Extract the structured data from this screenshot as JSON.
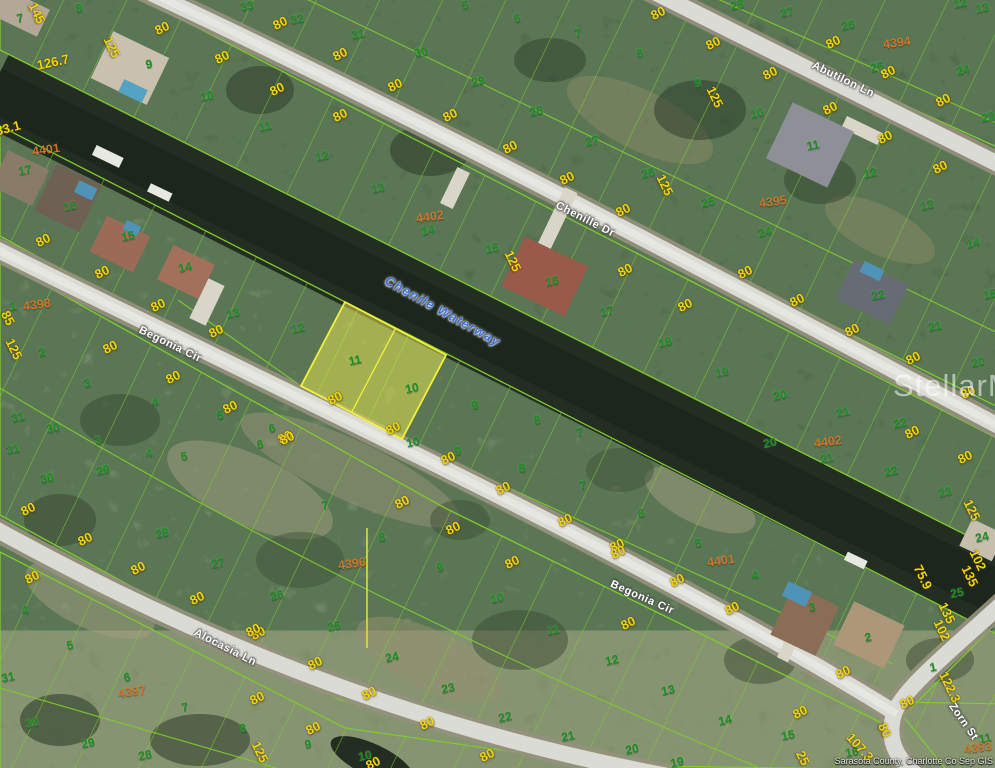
{
  "meta": {
    "watermark": "StellarMLS",
    "attribution": "Sarasota County, Charlotte Co Sep GIS",
    "highlighted_lots": [
      "11",
      "10"
    ]
  },
  "colors": {
    "parcel_line": "#7fcb2d",
    "highlight_fill": "#ebe950",
    "highlight_stroke": "#f3f13a",
    "lot_number": "#1d9021",
    "dimension": "#f2d40e",
    "block_number": "#c9762a",
    "street_text": "#ffffff",
    "waterway_text": "#3a6fd8",
    "water": "#232d22",
    "road": "#dadbd4",
    "watermark": "#ffffff"
  },
  "map": {
    "labels": [
      [
        "33",
        247,
        6,
        "lot"
      ],
      [
        "32",
        297,
        19,
        "lot"
      ],
      [
        "31",
        358,
        34,
        "lot"
      ],
      [
        "30",
        421,
        52,
        "lot"
      ],
      [
        "29",
        478,
        81,
        "lot"
      ],
      [
        "28",
        536,
        111,
        "lot"
      ],
      [
        "27",
        592,
        141,
        "lot"
      ],
      [
        "26",
        648,
        173,
        "lot"
      ],
      [
        "28",
        737,
        5,
        "lot"
      ],
      [
        "27",
        787,
        12,
        "lot"
      ],
      [
        "26",
        848,
        25,
        "lot"
      ],
      [
        "25",
        877,
        67,
        "lot"
      ],
      [
        "24",
        963,
        70,
        "lot"
      ],
      [
        "23",
        988,
        117,
        "lot"
      ],
      [
        "12",
        960,
        3,
        "lot"
      ],
      [
        "13",
        982,
        8,
        "lot"
      ],
      [
        "5",
        465,
        5,
        "lot"
      ],
      [
        "6",
        517,
        18,
        "lot"
      ],
      [
        "7",
        578,
        33,
        "lot"
      ],
      [
        "8",
        640,
        53,
        "lot"
      ],
      [
        "9",
        698,
        83,
        "lot"
      ],
      [
        "10",
        757,
        113,
        "lot"
      ],
      [
        "11",
        813,
        145,
        "lot"
      ],
      [
        "12",
        870,
        173,
        "lot"
      ],
      [
        "13",
        927,
        205,
        "lot"
      ],
      [
        "14",
        973,
        243,
        "lot"
      ],
      [
        "15",
        990,
        294,
        "lot"
      ],
      [
        "25",
        708,
        202,
        "lot"
      ],
      [
        "24",
        765,
        232,
        "lot"
      ],
      [
        "7",
        20,
        18,
        "lot"
      ],
      [
        "8",
        79,
        8,
        "lot"
      ],
      [
        "9",
        149,
        64,
        "lot"
      ],
      [
        "10",
        207,
        96,
        "lot"
      ],
      [
        "11",
        265,
        126,
        "lot"
      ],
      [
        "12",
        322,
        156,
        "lot"
      ],
      [
        "13",
        378,
        188,
        "lot"
      ],
      [
        "14",
        428,
        230,
        "lot"
      ],
      [
        "15",
        492,
        248,
        "lot"
      ],
      [
        "16",
        552,
        281,
        "lot"
      ],
      [
        "17",
        607,
        311,
        "lot"
      ],
      [
        "18",
        665,
        342,
        "lot"
      ],
      [
        "19",
        722,
        372,
        "lot"
      ],
      [
        "20",
        780,
        395,
        "lot"
      ],
      [
        "21",
        843,
        412,
        "lot"
      ],
      [
        "22",
        900,
        423,
        "lot"
      ],
      [
        "22",
        878,
        295,
        "lot"
      ],
      [
        "21",
        935,
        326,
        "lot"
      ],
      [
        "20",
        978,
        362,
        "lot"
      ],
      [
        "20",
        770,
        443,
        "lot"
      ],
      [
        "21",
        827,
        458,
        "lot"
      ],
      [
        "22",
        891,
        471,
        "lot"
      ],
      [
        "23",
        945,
        492,
        "lot"
      ],
      [
        "24",
        982,
        537,
        "lot"
      ],
      [
        "25",
        957,
        593,
        "lot"
      ],
      [
        "17",
        25,
        170,
        "lot"
      ],
      [
        "16",
        70,
        206,
        "lot"
      ],
      [
        "15",
        128,
        236,
        "lot"
      ],
      [
        "14",
        185,
        267,
        "lot"
      ],
      [
        "13",
        233,
        313,
        "lot"
      ],
      [
        "12",
        298,
        328,
        "lot"
      ],
      [
        "11",
        355,
        360,
        "lot"
      ],
      [
        "10",
        412,
        388,
        "lot"
      ],
      [
        "10",
        413,
        442,
        "lot"
      ],
      [
        "9",
        475,
        405,
        "lot"
      ],
      [
        "8",
        537,
        420,
        "lot"
      ],
      [
        "7",
        580,
        432,
        "lot"
      ],
      [
        "9",
        458,
        451,
        "lot"
      ],
      [
        "8",
        522,
        468,
        "lot"
      ],
      [
        "7",
        583,
        485,
        "lot"
      ],
      [
        "6",
        641,
        513,
        "lot"
      ],
      [
        "5",
        698,
        543,
        "lot"
      ],
      [
        "4",
        755,
        575,
        "lot"
      ],
      [
        "3",
        812,
        607,
        "lot"
      ],
      [
        "2",
        868,
        637,
        "lot"
      ],
      [
        "1",
        933,
        667,
        "lot"
      ],
      [
        "1",
        13,
        306,
        "lot"
      ],
      [
        "2",
        42,
        352,
        "lot"
      ],
      [
        "3",
        87,
        383,
        "lot"
      ],
      [
        "4",
        155,
        402,
        "lot"
      ],
      [
        "5",
        220,
        415,
        "lot"
      ],
      [
        "6",
        272,
        428,
        "lot"
      ],
      [
        "31",
        18,
        417,
        "lot"
      ],
      [
        "30",
        53,
        428,
        "lot"
      ],
      [
        "3",
        98,
        440,
        "lot"
      ],
      [
        "4",
        149,
        453,
        "lot"
      ],
      [
        "5",
        184,
        456,
        "lot"
      ],
      [
        "6",
        260,
        444,
        "lot"
      ],
      [
        "31",
        13,
        449,
        "lot"
      ],
      [
        "29",
        103,
        470,
        "lot"
      ],
      [
        "30",
        47,
        478,
        "lot"
      ],
      [
        "7",
        325,
        505,
        "lot"
      ],
      [
        "28",
        162,
        533,
        "lot"
      ],
      [
        "27",
        218,
        563,
        "lot"
      ],
      [
        "26",
        277,
        595,
        "lot"
      ],
      [
        "25",
        334,
        626,
        "lot"
      ],
      [
        "8",
        382,
        537,
        "lot"
      ],
      [
        "9",
        440,
        567,
        "lot"
      ],
      [
        "10",
        497,
        598,
        "lot"
      ],
      [
        "11",
        553,
        630,
        "lot"
      ],
      [
        "12",
        612,
        660,
        "lot"
      ],
      [
        "13",
        668,
        690,
        "lot"
      ],
      [
        "24",
        392,
        657,
        "lot"
      ],
      [
        "23",
        448,
        688,
        "lot"
      ],
      [
        "22",
        505,
        717,
        "lot"
      ],
      [
        "21",
        568,
        736,
        "lot"
      ],
      [
        "20",
        632,
        749,
        "lot"
      ],
      [
        "19",
        677,
        762,
        "lot"
      ],
      [
        "4",
        25,
        610,
        "lot"
      ],
      [
        "5",
        70,
        645,
        "lot"
      ],
      [
        "6",
        127,
        677,
        "lot"
      ],
      [
        "7",
        185,
        707,
        "lot"
      ],
      [
        "8",
        243,
        728,
        "lot"
      ],
      [
        "9",
        308,
        744,
        "lot"
      ],
      [
        "10",
        365,
        756,
        "lot"
      ],
      [
        "31",
        8,
        677,
        "lot"
      ],
      [
        "30",
        32,
        723,
        "lot"
      ],
      [
        "29",
        88,
        743,
        "lot"
      ],
      [
        "28",
        145,
        755,
        "lot"
      ],
      [
        "14",
        725,
        720,
        "lot"
      ],
      [
        "15",
        788,
        735,
        "lot"
      ],
      [
        "16",
        852,
        752,
        "lot"
      ],
      [
        "11",
        985,
        738,
        "lot"
      ],
      [
        "80",
        162,
        28,
        "dim"
      ],
      [
        "80",
        222,
        57,
        "dim"
      ],
      [
        "80",
        280,
        23,
        "dim"
      ],
      [
        "80",
        277,
        89,
        "dim"
      ],
      [
        "80",
        340,
        115,
        "dim"
      ],
      [
        "80",
        340,
        54,
        "dim"
      ],
      [
        "80",
        395,
        85,
        "dim"
      ],
      [
        "80",
        450,
        115,
        "dim"
      ],
      [
        "80",
        510,
        147,
        "dim"
      ],
      [
        "80",
        567,
        178,
        "dim"
      ],
      [
        "80",
        623,
        210,
        "dim"
      ],
      [
        "80",
        658,
        13,
        "dim"
      ],
      [
        "80",
        713,
        43,
        "dim"
      ],
      [
        "80",
        770,
        73,
        "dim"
      ],
      [
        "80",
        833,
        42,
        "dim"
      ],
      [
        "80",
        888,
        72,
        "dim"
      ],
      [
        "80",
        943,
        100,
        "dim"
      ],
      [
        "80",
        830,
        108,
        "dim"
      ],
      [
        "80",
        885,
        137,
        "dim"
      ],
      [
        "80",
        940,
        167,
        "dim"
      ],
      [
        "80",
        43,
        240,
        "dim"
      ],
      [
        "80",
        102,
        272,
        "dim"
      ],
      [
        "80",
        158,
        305,
        "dim"
      ],
      [
        "80",
        110,
        347,
        "dim"
      ],
      [
        "80",
        173,
        377,
        "dim"
      ],
      [
        "80",
        216,
        331,
        "dim"
      ],
      [
        "80",
        230,
        407,
        "dim"
      ],
      [
        "80",
        285,
        437,
        "dim"
      ],
      [
        "80",
        335,
        398,
        "dim"
      ],
      [
        "80",
        393,
        428,
        "dim"
      ],
      [
        "80",
        448,
        458,
        "dim"
      ],
      [
        "80",
        503,
        488,
        "dim"
      ],
      [
        "80",
        565,
        520,
        "dim"
      ],
      [
        "80",
        617,
        545,
        "dim"
      ],
      [
        "80",
        453,
        528,
        "dim"
      ],
      [
        "80",
        625,
        270,
        "dim"
      ],
      [
        "80",
        685,
        305,
        "dim"
      ],
      [
        "80",
        745,
        272,
        "dim"
      ],
      [
        "80",
        797,
        300,
        "dim"
      ],
      [
        "80",
        852,
        330,
        "dim"
      ],
      [
        "80",
        913,
        358,
        "dim"
      ],
      [
        "80",
        968,
        392,
        "dim"
      ],
      [
        "80",
        912,
        432,
        "dim"
      ],
      [
        "80",
        965,
        457,
        "dim"
      ],
      [
        "80",
        402,
        502,
        "dim"
      ],
      [
        "80",
        512,
        562,
        "dim"
      ],
      [
        "80",
        618,
        552,
        "dim"
      ],
      [
        "80",
        258,
        633,
        "dim"
      ],
      [
        "80",
        315,
        663,
        "dim"
      ],
      [
        "80",
        369,
        693,
        "dim"
      ],
      [
        "80",
        427,
        723,
        "dim"
      ],
      [
        "80",
        487,
        755,
        "dim"
      ],
      [
        "80",
        628,
        623,
        "dim"
      ],
      [
        "80",
        373,
        763,
        "dim"
      ],
      [
        "80",
        28,
        509,
        "dim"
      ],
      [
        "80",
        85,
        539,
        "dim"
      ],
      [
        "80",
        138,
        568,
        "dim"
      ],
      [
        "80",
        32,
        577,
        "dim"
      ],
      [
        "80",
        287,
        438,
        "dim"
      ],
      [
        "80",
        197,
        598,
        "dim"
      ],
      [
        "80",
        253,
        630,
        "dim"
      ],
      [
        "80",
        257,
        698,
        "dim"
      ],
      [
        "80",
        313,
        728,
        "dim"
      ],
      [
        "80",
        677,
        580,
        "dim"
      ],
      [
        "80",
        732,
        608,
        "dim"
      ],
      [
        "80",
        800,
        712,
        "dim"
      ],
      [
        "80",
        907,
        702,
        "dim"
      ],
      [
        "80",
        843,
        672,
        "dim"
      ],
      [
        "80",
        885,
        730,
        "dim",
        64
      ],
      [
        "126.7",
        53,
        62,
        "dim",
        -12
      ],
      [
        "33.1",
        8,
        128,
        "dim",
        -15
      ],
      [
        "145",
        37,
        13,
        "dim",
        64
      ],
      [
        "125",
        112,
        47,
        "dim",
        64
      ],
      [
        "125",
        715,
        97,
        "dim",
        64
      ],
      [
        "125",
        665,
        185,
        "dim",
        64
      ],
      [
        "125",
        513,
        261,
        "dim",
        64
      ],
      [
        "85",
        8,
        318,
        "dim",
        64
      ],
      [
        "125",
        14,
        349,
        "dim",
        64
      ],
      [
        "125",
        972,
        510,
        "dim",
        64
      ],
      [
        "102",
        978,
        560,
        "dim",
        64
      ],
      [
        "135",
        970,
        576,
        "dim",
        64
      ],
      [
        "75.9",
        923,
        577,
        "dim",
        64
      ],
      [
        "135",
        947,
        613,
        "dim",
        64
      ],
      [
        "102",
        942,
        630,
        "dim",
        64
      ],
      [
        "122.3",
        950,
        687,
        "dim",
        64
      ],
      [
        "107.3",
        860,
        747,
        "dim",
        48
      ],
      [
        "25",
        803,
        758,
        "dim",
        64
      ],
      [
        "125",
        260,
        752,
        "dim",
        64
      ],
      [
        "4394",
        897,
        43,
        "blk"
      ],
      [
        "4395",
        773,
        202,
        "blk"
      ],
      [
        "4402",
        430,
        217,
        "blk"
      ],
      [
        "4402",
        828,
        442,
        "blk"
      ],
      [
        "4401",
        46,
        150,
        "blk"
      ],
      [
        "4401",
        721,
        561,
        "blk"
      ],
      [
        "4398",
        37,
        305,
        "blk"
      ],
      [
        "4396",
        352,
        564,
        "blk"
      ],
      [
        "4397",
        132,
        692,
        "blk"
      ],
      [
        "4393",
        978,
        748,
        "blk"
      ],
      [
        "Chenille Dr",
        585,
        220,
        "st",
        27
      ],
      [
        "Abutilon Ln",
        843,
        80,
        "st",
        26
      ],
      [
        "Begonia Cir",
        170,
        345,
        "st",
        26
      ],
      [
        "Begonia Cir",
        642,
        598,
        "st",
        24
      ],
      [
        "Alocasia Ln",
        225,
        648,
        "st",
        27
      ],
      [
        "Zorn St",
        963,
        722,
        "st",
        55
      ],
      [
        "Chenile Waterway",
        443,
        311,
        "ww",
        29
      ]
    ]
  }
}
